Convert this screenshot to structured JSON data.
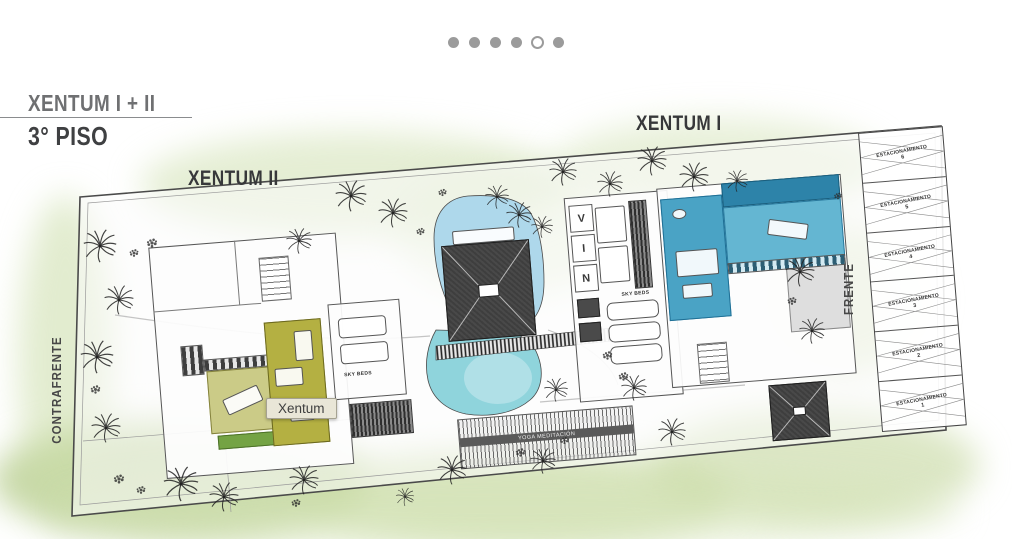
{
  "carousel": {
    "count": 6,
    "active_index": 4,
    "dot_color": "#9b9b9b"
  },
  "header": {
    "title": "XENTUM I + II",
    "subtitle": "3° PISO"
  },
  "plan_labels": {
    "building_left": "XENTUM II",
    "building_right": "XENTUM I",
    "side_back": "CONTRAFRENTE",
    "side_front": "FRENTE",
    "sky_beds_left": "SKY BEDS",
    "sky_beds_middle": "SKY BEDS",
    "vin_letters": [
      "V",
      "I",
      "N"
    ],
    "yoga_deck": "YOGA MEDITACIÓN"
  },
  "tooltip": {
    "text": "Xentum"
  },
  "parking": {
    "stalls": [
      {
        "label": "ESTACIONAMIENTO",
        "number": "6"
      },
      {
        "label": "ESTACIONAMIENTO",
        "number": "5"
      },
      {
        "label": "ESTACIONAMIENTO",
        "number": "4"
      },
      {
        "label": "ESTACIONAMIENTO",
        "number": "3"
      },
      {
        "label": "ESTACIONAMIENTO",
        "number": "2"
      },
      {
        "label": "ESTACIONAMIENTO",
        "number": "1"
      }
    ]
  },
  "colors": {
    "unit_xentum_ii": "#b4b042",
    "unit_xentum_i": "#4aa3c5",
    "pool_upper": "#aed8eb",
    "pool_lower": "#8fd4dc",
    "wash_green": "#c6d8a0",
    "carousel_dot": "#9b9b9b",
    "tooltip_bg": "#e9e6d7"
  }
}
